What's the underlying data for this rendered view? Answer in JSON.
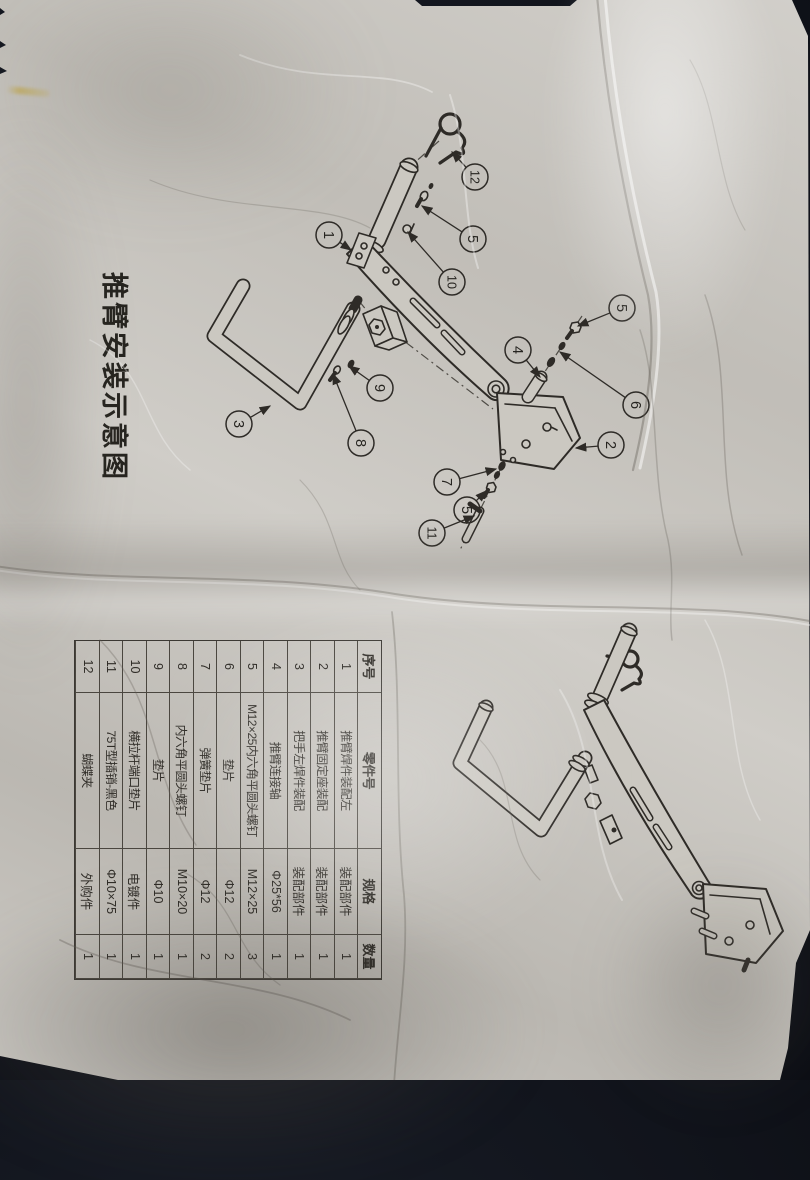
{
  "photo": {
    "background_color": "#12151d",
    "paper_color": "#c9c6c0",
    "line_color": "#2e2b27"
  },
  "title": "推臂安装示意图",
  "table": {
    "headers": [
      "序号",
      "零件号",
      "规格",
      "数量"
    ],
    "rows": [
      [
        "1",
        "推臂焊件装配左",
        "装配部件",
        "1"
      ],
      [
        "2",
        "推臂固定座装配",
        "装配部件",
        "1"
      ],
      [
        "3",
        "把手左焊件装配",
        "装配部件",
        "1"
      ],
      [
        "4",
        "推臂连接轴",
        "Φ25*56",
        "1"
      ],
      [
        "5",
        "M12×25内六角平圆头螺钉",
        "M12×25",
        "3"
      ],
      [
        "6",
        "垫片",
        "Φ12",
        "2"
      ],
      [
        "7",
        "弹簧垫片",
        "Φ12",
        "2"
      ],
      [
        "8",
        "内六角平圆头螺钉",
        "M10×20",
        "1"
      ],
      [
        "9",
        "垫片",
        "Φ10",
        "1"
      ],
      [
        "10",
        "横拉杆端口垫片",
        "电镀件",
        "1"
      ],
      [
        "11",
        "75T型插销-黑色",
        "Φ10×75",
        "1"
      ],
      [
        "12",
        "蝴蝶夹",
        "外购件",
        "1"
      ]
    ]
  },
  "callouts": {
    "exploded": [
      "12",
      "5",
      "10",
      "1",
      "9",
      "8",
      "3",
      "5",
      "4",
      "6",
      "2",
      "7",
      "5",
      "11"
    ]
  }
}
